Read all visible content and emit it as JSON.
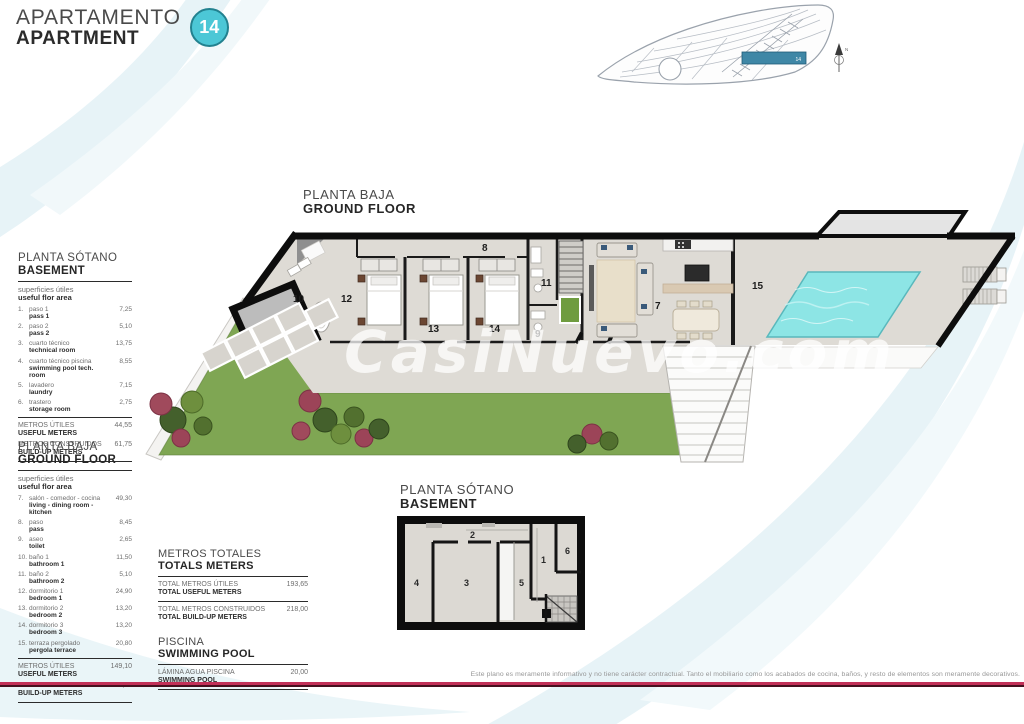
{
  "header": {
    "title_es": "APARTAMENTO",
    "title_en": "APARTMENT",
    "unit_badge": "14"
  },
  "watermark": "CasiNuevo.com",
  "colors": {
    "accent_teal": "#4cc7d6",
    "pool_water": "#8de5e5",
    "site_highlight": "#3f87a6",
    "garden_green": "#7fa653",
    "footer_line": "#c23058"
  },
  "plans": {
    "ground_floor": {
      "title_es": "PLANTA BAJA",
      "title_en": "GROUND FLOOR",
      "rooms": {
        "r7": "7",
        "r8": "8",
        "r9": "9",
        "r10": "10",
        "r11": "11",
        "r12": "12",
        "r13": "13",
        "r14": "14",
        "r15": "15"
      }
    },
    "basement": {
      "title_es": "PLANTA SÓTANO",
      "title_en": "BASEMENT",
      "rooms": {
        "r1": "1",
        "r2": "2",
        "r3": "3",
        "r4": "4",
        "r5": "5",
        "r6": "6"
      }
    },
    "site": {
      "unit_label": "14",
      "compass_label": "N"
    }
  },
  "legend_basement": {
    "title_es": "PLANTA SÓTANO",
    "title_en": "BASEMENT",
    "subtitle_es": "superficies útiles",
    "subtitle_en": "useful flor area",
    "items": [
      {
        "num": "1.",
        "es": "paso 1",
        "en": "pass 1",
        "value": "7,25"
      },
      {
        "num": "2.",
        "es": "paso 2",
        "en": "pass 2",
        "value": "5,10"
      },
      {
        "num": "3.",
        "es": "cuarto técnico",
        "en": "technical room",
        "value": "13,75"
      },
      {
        "num": "4.",
        "es": "cuarto técnico piscina",
        "en": "swimming pool tech. room",
        "value": "8,55"
      },
      {
        "num": "5.",
        "es": "lavadero",
        "en": "laundry",
        "value": "7,15"
      },
      {
        "num": "6.",
        "es": "trastero",
        "en": "storage room",
        "value": "2,75"
      }
    ],
    "totals": [
      {
        "es": "METROS ÚTILES",
        "en": "USEFUL METERS",
        "value": "44,55"
      },
      {
        "es": "METROS CONSTRUIDOS",
        "en": "BUILD-UP METERS",
        "value": "61,75"
      }
    ]
  },
  "legend_ground": {
    "title_es": "PLANTA BAJA",
    "title_en": "GROUND FLOOR",
    "subtitle_es": "superficies útiles",
    "subtitle_en": "useful flor area",
    "items": [
      {
        "num": "7.",
        "es": "salón - comedor - cocina",
        "en": "living - dining room - kitchen",
        "value": "49,30"
      },
      {
        "num": "8.",
        "es": "paso",
        "en": "pass",
        "value": "8,45"
      },
      {
        "num": "9.",
        "es": "aseo",
        "en": "toilet",
        "value": "2,65"
      },
      {
        "num": "10.",
        "es": "baño 1",
        "en": "bathroom 1",
        "value": "11,50"
      },
      {
        "num": "11.",
        "es": "baño 2",
        "en": "bathroom 2",
        "value": "5,10"
      },
      {
        "num": "12.",
        "es": "dormitorio 1",
        "en": "bedroom 1",
        "value": "24,90"
      },
      {
        "num": "13.",
        "es": "dormitorio 2",
        "en": "bedroom 2",
        "value": "13,20"
      },
      {
        "num": "14.",
        "es": "dormitorio 3",
        "en": "bedroom 3",
        "value": "13,20"
      },
      {
        "num": "15.",
        "es": "terraza pergolado",
        "en": "pergola terrace",
        "value": "20,80"
      }
    ],
    "totals": [
      {
        "es": "METROS ÚTILES",
        "en": "USEFUL METERS",
        "value": "149,10"
      },
      {
        "es": "METROS CONSTRUIDOS",
        "en": "BUILD-UP METERS",
        "value": "156,25"
      }
    ]
  },
  "grand_totals": {
    "title_es": "METROS TOTALES",
    "title_en": "TOTALS METERS",
    "rows": [
      {
        "es": "TOTAL METROS ÚTILES",
        "en": "TOTAL USEFUL METERS",
        "value": "193,65"
      },
      {
        "es": "TOTAL METROS CONSTRUIDOS",
        "en": "TOTAL BUILD-UP METERS",
        "value": "218,00"
      }
    ],
    "pool_title_es": "PISCINA",
    "pool_title_en": "SWIMMING POOL",
    "pool_row": {
      "es": "LÁMINA AGUA PISCINA",
      "en": "SWIMMING POOL",
      "value": "20,00"
    }
  },
  "footer": {
    "disclaimer": "Este plano es meramente informativo y no tiene carácter contractual. Tanto el mobiliario como los acabados de cocina, baños, y resto de elementos son meramente decorativos."
  }
}
